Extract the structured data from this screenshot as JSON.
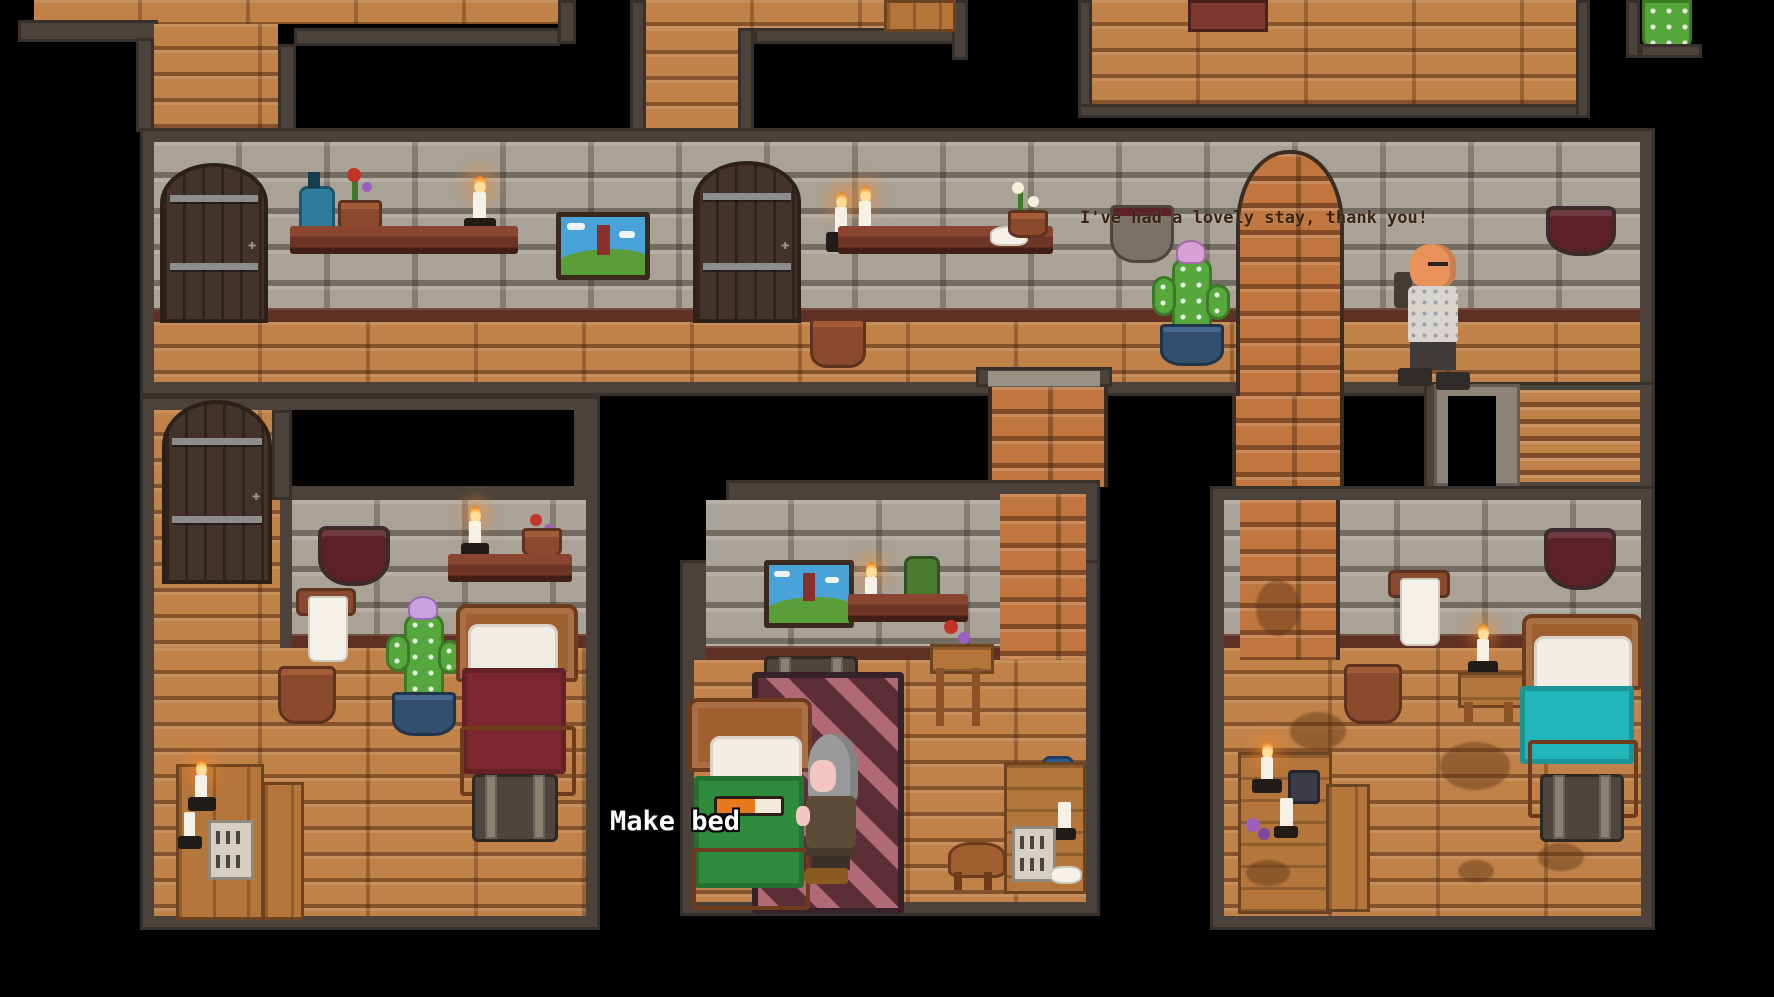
{
  "hud": {
    "speech": "I've had a lovely stay, thank you!",
    "action_label": "Make bed",
    "progress_percent": 60
  },
  "npcs": [
    {
      "name": "guest",
      "description": "bald guest in grey shirt walking through the hallway"
    },
    {
      "name": "maid",
      "description": "grey-haired maid standing beside the bed being made"
    }
  ],
  "objects": [
    "wooden-door",
    "wall-shelf",
    "blue-bottle",
    "flower-pot",
    "lit-candle",
    "landscape-painting",
    "candle-sconce",
    "white-flowers",
    "plate",
    "wall-basin",
    "potted-cactus",
    "brick-archway",
    "wall-bowl",
    "staircase",
    "stairwell",
    "bed",
    "pillow",
    "storage-chest",
    "towel-hook",
    "towel",
    "clay-pot",
    "light-switch",
    "striped-rug",
    "nightstand",
    "writing-desk",
    "stool",
    "vanity-dresser",
    "bench",
    "privacy-screen",
    "green-bottle"
  ],
  "palette": {
    "background": "#000000",
    "room_border": "#4a423b",
    "stone_wall": "#a9a296",
    "wood_floor": "#c1824a",
    "brick": "#c0763e",
    "bed_red": "#7d2830",
    "bed_green": "#2f8c3e",
    "bed_teal": "#22b5ba",
    "rug_dark": "#5c2e38",
    "rug_light": "#b06a76",
    "progress_fill": "#e8791a",
    "speech_text": "#3a2416"
  }
}
